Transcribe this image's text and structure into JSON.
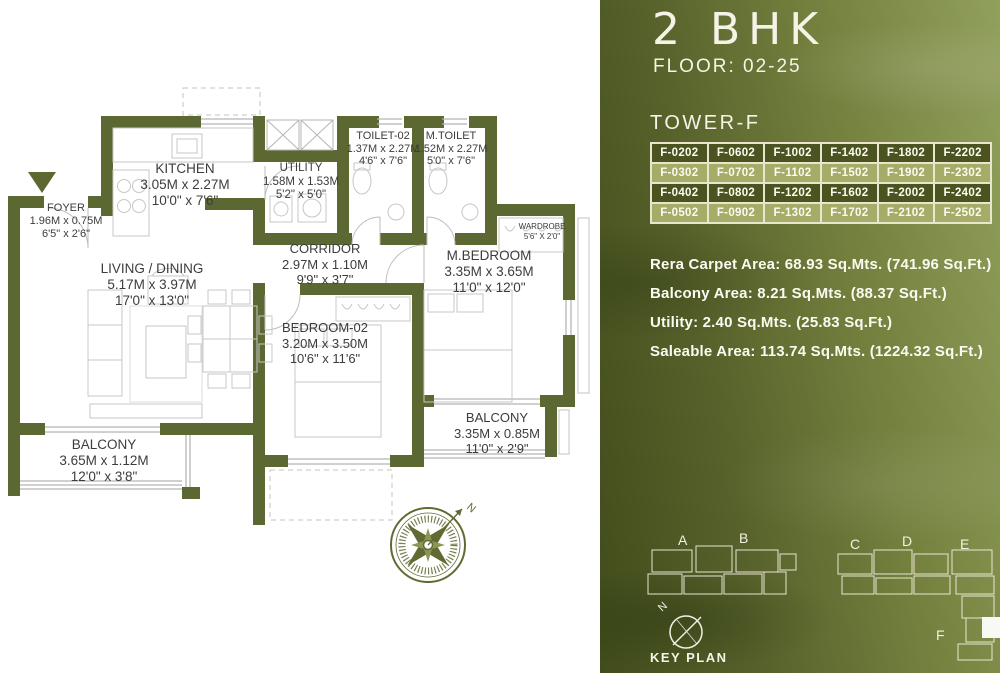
{
  "colors": {
    "wall": "#5c6831",
    "panel_dark": "#414c1b",
    "panel_light": "#92a05d",
    "table_row_dark": "#4b5420",
    "table_row_light": "#a4ac68",
    "panel_text": "#f6f4e7",
    "plan_text": "#3c3c3a"
  },
  "floorplan": {
    "north_label": "N",
    "rooms": {
      "foyer": {
        "name": "FOYER",
        "metric": "1.96M x 0.75M",
        "imperial": "6'5\" x 2'6\""
      },
      "kitchen": {
        "name": "KITCHEN",
        "metric": "3.05M x 2.27M",
        "imperial": "10'0\" x 7'6\""
      },
      "utility": {
        "name": "UTILITY",
        "metric": "1.58M x 1.53M",
        "imperial": "5'2\" x 5'0\""
      },
      "toilet2": {
        "name": "TOILET-02",
        "metric": "1.37M x 2.27M",
        "imperial": "4'6\" x 7'6\""
      },
      "mtoilet": {
        "name": "M.TOILET",
        "metric": "1.52M x 2.27M",
        "imperial": "5'0\" x 7'6\""
      },
      "wardrobe": {
        "name": "WARDROBE",
        "imperial": "5'6\" X 2'0\""
      },
      "corridor": {
        "name": "CORRIDOR",
        "metric": "2.97M x 1.10M",
        "imperial": "9'9\" x 3'7\""
      },
      "mbedroom": {
        "name": "M.BEDROOM",
        "metric": "3.35M x 3.65M",
        "imperial": "11'0\" x 12'0\""
      },
      "living": {
        "name": "LIVING / DINING",
        "metric": "5.17M x 3.97M",
        "imperial": "17'0\" x 13'0\""
      },
      "bedroom2": {
        "name": "BEDROOM-02",
        "metric": "3.20M x 3.50M",
        "imperial": "10'6\" x 11'6\""
      },
      "balcony_left": {
        "name": "BALCONY",
        "metric": "3.65M x 1.12M",
        "imperial": "12'0\" x 3'8\""
      },
      "balcony_right": {
        "name": "BALCONY",
        "metric": "3.35M x 0.85M",
        "imperial": "11'0\" x 2'9\""
      }
    }
  },
  "panel": {
    "title": "2 BHK",
    "floor_label": "FLOOR: 02-25",
    "tower_label": "TOWER-F",
    "units": [
      [
        "F-0202",
        "F-0602",
        "F-1002",
        "F-1402",
        "F-1802",
        "F-2202"
      ],
      [
        "F-0302",
        "F-0702",
        "F-1102",
        "F-1502",
        "F-1902",
        "F-2302"
      ],
      [
        "F-0402",
        "F-0802",
        "F-1202",
        "F-1602",
        "F-2002",
        "F-2402"
      ],
      [
        "F-0502",
        "F-0902",
        "F-1302",
        "F-1702",
        "F-2102",
        "F-2502"
      ]
    ],
    "areas": [
      "Rera Carpet Area: 68.93 Sq.Mts. (741.96 Sq.Ft.)",
      "Balcony Area: 8.21 Sq.Mts. (88.37 Sq.Ft.)",
      "Utility: 2.40 Sq.Mts. (25.83 Sq.Ft.)",
      "Saleable Area: 113.74 Sq.Mts. (1224.32 Sq.Ft.)"
    ],
    "key_plan": {
      "label": "KEY PLAN",
      "north": "N",
      "buildings": [
        "A",
        "B",
        "C",
        "D",
        "E",
        "F"
      ]
    }
  }
}
